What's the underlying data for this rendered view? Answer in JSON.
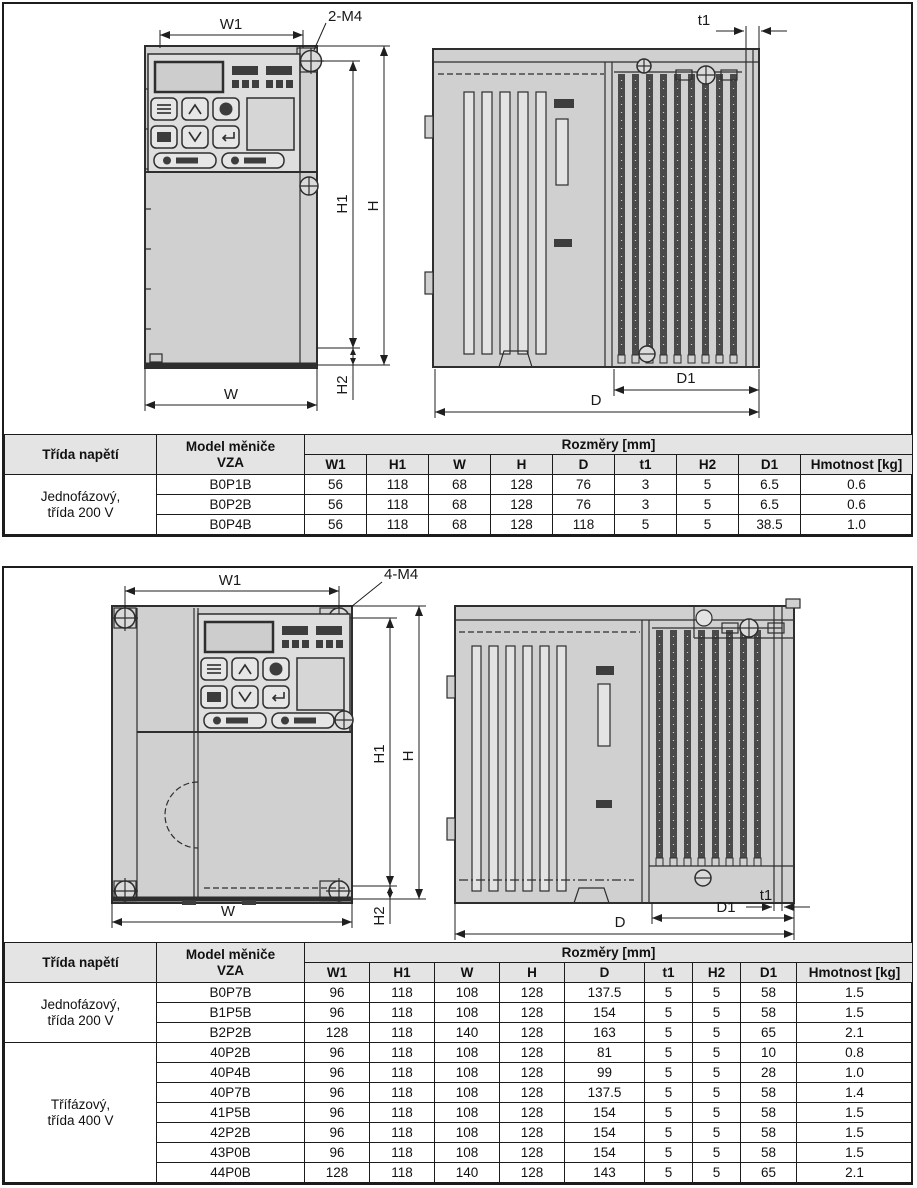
{
  "colors": {
    "line": "#2e2e2e",
    "body_fill": "#d0d0d0",
    "panel_fill": "#dedede",
    "fin_dark": "#4a4a4a",
    "table_header_bg": "#e4e4e4",
    "border": "#1c1c1c"
  },
  "section1": {
    "dim_labels": {
      "w1": "W1",
      "m4": "2-M4",
      "t1": "t1",
      "h1": "H1",
      "h": "H",
      "h2": "H2",
      "w": "W",
      "d1": "D1",
      "d": "D"
    },
    "table": {
      "header_voltage": "Třída napětí",
      "header_model_1": "Model měniče",
      "header_model_2": "VZA",
      "header_dims": "Rozměry [mm]",
      "dim_cols": [
        "W1",
        "H1",
        "W",
        "H",
        "D",
        "t1",
        "H2",
        "D1"
      ],
      "header_weight": "Hmotnost [kg]",
      "groups": [
        {
          "label_1": "Jednofázový,",
          "label_2": "třída 200 V",
          "rows": [
            [
              "B0P1B",
              "56",
              "118",
              "68",
              "128",
              "76",
              "3",
              "5",
              "6.5",
              "0.6"
            ],
            [
              "B0P2B",
              "56",
              "118",
              "68",
              "128",
              "76",
              "3",
              "5",
              "6.5",
              "0.6"
            ],
            [
              "B0P4B",
              "56",
              "118",
              "68",
              "128",
              "118",
              "5",
              "5",
              "38.5",
              "1.0"
            ]
          ]
        }
      ]
    }
  },
  "section2": {
    "dim_labels": {
      "w1": "W1",
      "m4": "4-M4",
      "t1": "t1",
      "h1": "H1",
      "h": "H",
      "h2": "H2",
      "w": "W",
      "d1": "D1",
      "d": "D"
    },
    "table": {
      "header_voltage": "Třída napětí",
      "header_model_1": "Model měniče",
      "header_model_2": "VZA",
      "header_dims": "Rozměry [mm]",
      "dim_cols": [
        "W1",
        "H1",
        "W",
        "H",
        "D",
        "t1",
        "H2",
        "D1"
      ],
      "header_weight": "Hmotnost [kg]",
      "groups": [
        {
          "label_1": "Jednofázový,",
          "label_2": "třída 200 V",
          "rows": [
            [
              "B0P7B",
              "96",
              "118",
              "108",
              "128",
              "137.5",
              "5",
              "5",
              "58",
              "1.5"
            ],
            [
              "B1P5B",
              "96",
              "118",
              "108",
              "128",
              "154",
              "5",
              "5",
              "58",
              "1.5"
            ],
            [
              "B2P2B",
              "128",
              "118",
              "140",
              "128",
              "163",
              "5",
              "5",
              "65",
              "2.1"
            ]
          ]
        },
        {
          "label_1": "Třífázový,",
          "label_2": "třída 400 V",
          "rows": [
            [
              "40P2B",
              "96",
              "118",
              "108",
              "128",
              "81",
              "5",
              "5",
              "10",
              "0.8"
            ],
            [
              "40P4B",
              "96",
              "118",
              "108",
              "128",
              "99",
              "5",
              "5",
              "28",
              "1.0"
            ],
            [
              "40P7B",
              "96",
              "118",
              "108",
              "128",
              "137.5",
              "5",
              "5",
              "58",
              "1.4"
            ],
            [
              "41P5B",
              "96",
              "118",
              "108",
              "128",
              "154",
              "5",
              "5",
              "58",
              "1.5"
            ],
            [
              "42P2B",
              "96",
              "118",
              "108",
              "128",
              "154",
              "5",
              "5",
              "58",
              "1.5"
            ],
            [
              "43P0B",
              "96",
              "118",
              "108",
              "128",
              "154",
              "5",
              "5",
              "58",
              "1.5"
            ],
            [
              "44P0B",
              "128",
              "118",
              "140",
              "128",
              "143",
              "5",
              "5",
              "65",
              "2.1"
            ]
          ]
        }
      ]
    }
  }
}
